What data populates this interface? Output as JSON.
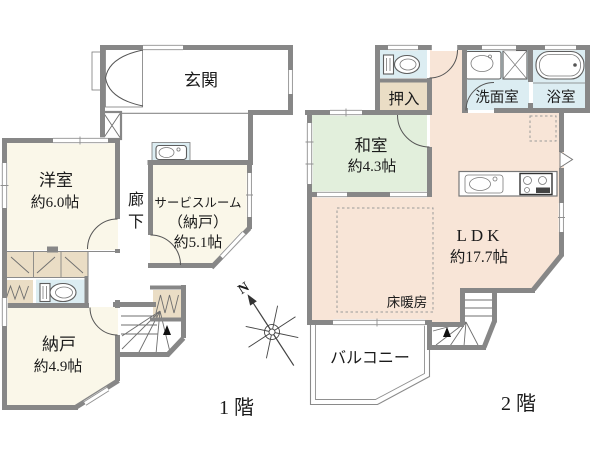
{
  "colors": {
    "wall": "#878787",
    "cream": "#faf7e9",
    "tan": "#eaddc5",
    "blue": "#dcedf2",
    "green": "#e2efdc",
    "peach": "#f8e5d7",
    "white": "#ffffff",
    "text": "#1b1b1b"
  },
  "compass": {
    "north_label": "N"
  },
  "floor1": {
    "floor_label": "1階",
    "rooms": {
      "genkan": {
        "name": "玄関"
      },
      "youshitsu": {
        "name": "洋室",
        "area": "約6.0帖"
      },
      "rouka": {
        "name": "廊下",
        "chars": [
          "廊",
          "下"
        ]
      },
      "service_room": {
        "name_line1": "サービスルーム",
        "name_line2": "（納戸）",
        "area": "約5.1帖"
      },
      "nando": {
        "name": "納戸",
        "area": "約4.9帖"
      }
    }
  },
  "floor2": {
    "floor_label": "2階",
    "rooms": {
      "oshiire": {
        "name": "押入"
      },
      "washitsu": {
        "name": "和室",
        "area": "約4.3帖"
      },
      "senmenshitsu": {
        "name": "洗面室"
      },
      "yokushitsu": {
        "name": "浴室"
      },
      "ldk": {
        "name": "LDK",
        "area": "約17.7帖"
      },
      "yuka_danbou": {
        "name": "床暖房"
      },
      "balcony": {
        "name": "バルコニー"
      }
    }
  }
}
